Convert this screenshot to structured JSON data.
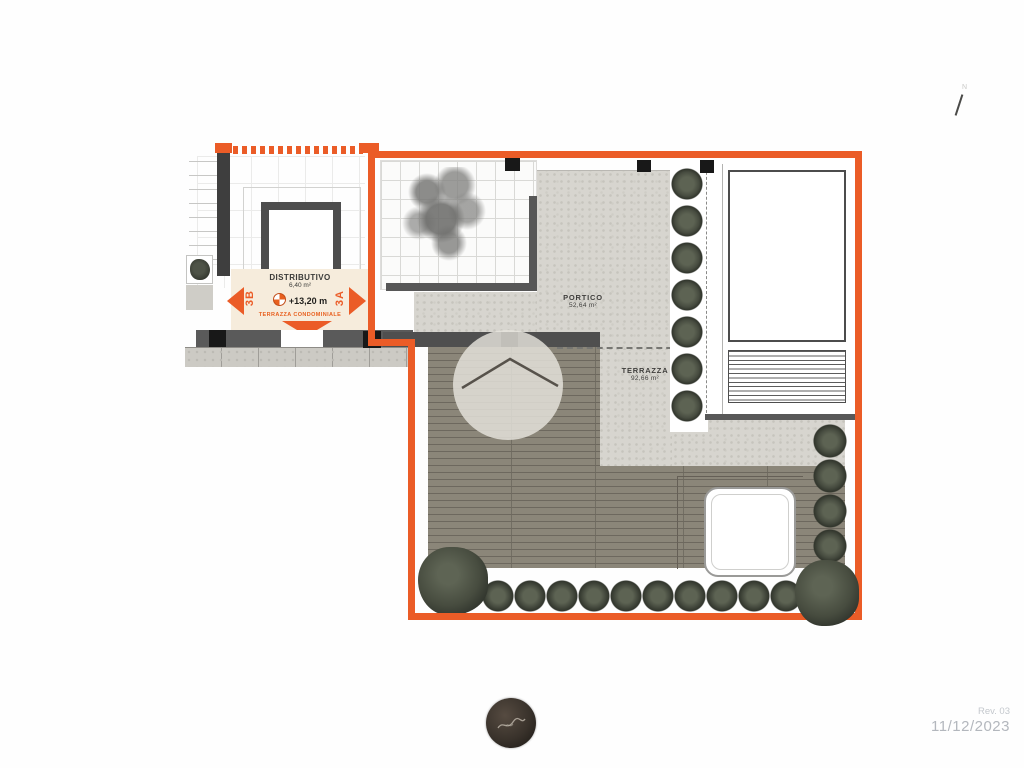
{
  "plan": {
    "distributivo": {
      "title": "DISTRIBUTIVO",
      "area": "6,40 m²",
      "level": "+13,20 m",
      "condo_label": "TERRAZZA CONDOMINIALE",
      "unit_left": "3B",
      "unit_right": "3A"
    },
    "portico": {
      "title": "PORTICO",
      "area": "52,64 m²"
    },
    "terrazza": {
      "title": "TERRAZZA",
      "area": "92,66 m²"
    },
    "north_mark": "N"
  },
  "footer": {
    "revision": "Rev. 03",
    "date": "11/12/2023"
  },
  "icons": {
    "level_marker": "quadrant-circle-elevation-marker",
    "logo": "dark-circle-script-monogram"
  },
  "colors": {
    "boundary_orange": "#eb5c27",
    "hedge_green": "#4a4f42",
    "decking": "#8b8679",
    "pebble_paving": "#d7d5cf",
    "cream_landing": "#f6ecdc",
    "wall_dark": "#4f4f4f",
    "footer_text": "#b3b7bd"
  }
}
